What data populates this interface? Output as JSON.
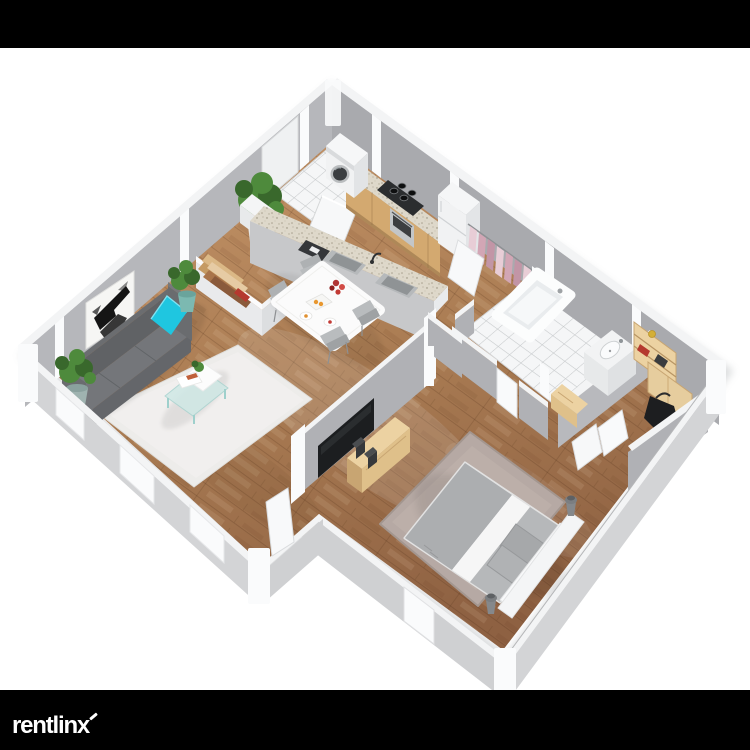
{
  "branding": {
    "logo_text": "rentlinx"
  },
  "palette": {
    "page_bg": "#ffffff",
    "letterbox": "#000000",
    "logo_color": "#ffffff",
    "wall_left": "#b6b7bb",
    "wall_right": "#a9aaae",
    "wall_interior": "#b0b1b5",
    "wall_top": "#f3f4f5",
    "wall_exterior": "#d3d4d6",
    "jamb_white": "#fafbfc",
    "floor_light": "#c49468",
    "floor_mid": "#aa7c53",
    "floor_dark": "#8e6142",
    "tile": "#f5f6f7",
    "grout": "#c6c9cb",
    "rug_living": "#edecea",
    "rug_bedroom": "#b6a9a4",
    "sofa_dark": "#606265",
    "sofa_mid": "#74767a",
    "sofa_front": "#64666a",
    "pillow_cyan": "#1fc6e0",
    "art_bg": "#f6f6f4",
    "art_ink": "#151515",
    "plant_green": "#4e8a3c",
    "plant_green_dark": "#39682c",
    "pot_white": "#f1f1f1",
    "pot_teal": "#7cb9b1",
    "table_white": "#fbfbfb",
    "chair_grey": "#b9bcbe",
    "counter_wood": "#d3a970",
    "granite": "#ded8ca",
    "stove_black": "#2b2d2f",
    "steel": "#c3c6c8",
    "appliance_white": "#f1f2f3",
    "clothes_pink": "#d2a6b5",
    "clothes_light": "#e8cdd6",
    "tub_white": "#fcfdfd",
    "bed_sheet": "#f4f4f4",
    "bed_blanket": "#acaeb0",
    "bed_pillow": "#a6a8aa",
    "wood_light": "#ecd2a2",
    "wood_mid": "#dfc08a",
    "wood_dark": "#c8a572",
    "tv_black": "#1c1e20",
    "speaker_dark": "#36383b",
    "bag_black": "#1d1e20",
    "accent_red": "#b5392f",
    "flower_red": "#c23b35"
  },
  "scene": {
    "type": "isometric-3d-floorplan",
    "rooms": [
      {
        "name": "living-room",
        "furniture": [
          "sofa",
          "throw-pillow",
          "wall-art",
          "coffee-table",
          "area-rug",
          "potted-plants",
          "bookshelf-divider"
        ]
      },
      {
        "name": "kitchen",
        "furniture": [
          "counter",
          "gas-stove",
          "oven",
          "refrigerator",
          "washing-machine",
          "island-with-sinks"
        ]
      },
      {
        "name": "dining-area",
        "furniture": [
          "dining-table",
          "four-chairs",
          "flowers",
          "plates"
        ]
      },
      {
        "name": "bedroom",
        "furniture": [
          "double-bed",
          "pillows",
          "tv",
          "media-dresser",
          "shag-rug",
          "bedside-lamps"
        ]
      },
      {
        "name": "bathroom",
        "furniture": [
          "bathtub",
          "sink",
          "wood-bench",
          "tile-floor"
        ]
      },
      {
        "name": "closets",
        "furniture": [
          "hanging-clothes",
          "storage-shelf",
          "bag"
        ]
      }
    ]
  }
}
